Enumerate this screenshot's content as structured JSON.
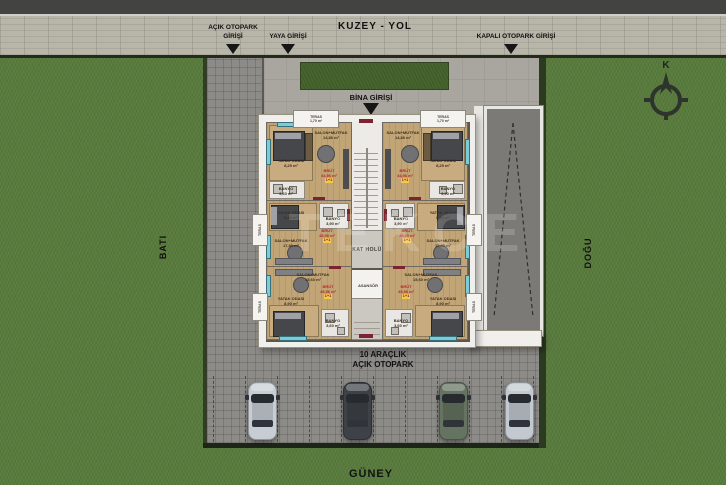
{
  "road": {
    "name_label": "KUZEY - YOL"
  },
  "entrances": {
    "open_parking_line1": "AÇIK OTOPARK",
    "open_parking_line2": "GİRİŞİ",
    "pedestrian": "YAYA GİRİŞİ",
    "closed_parking": "KAPALI OTOPARK GİRİŞİ",
    "building": "BİNA GİRİŞİ"
  },
  "compass": {
    "north_letter": "K"
  },
  "directions": {
    "west": "BATI",
    "east": "DOĞU",
    "south": "GÜNEY"
  },
  "open_parking": {
    "label_line1": "10 ARAÇLIK",
    "label_line2": "AÇIK OTOPARK",
    "capacity": 10,
    "car_colors": [
      "#c7cdd4",
      "#3e4248",
      "#657461",
      "#c3c9d0"
    ]
  },
  "watermark_text": "TEKCE",
  "core": {
    "hall_label": "KAT HOLÜ",
    "elevator_label": "ASANSÖR"
  },
  "terraces": {
    "label": "TERAS",
    "top_area": "1,70 m²",
    "side_area": "1,50 m²"
  },
  "units": [
    {
      "id": "top-left",
      "living": "SALON+MUTFAK",
      "living_area": "14,86 m²",
      "bedroom": "YATAK ODASI",
      "bedroom_area": "8,25 m²",
      "bath": "BANYO",
      "bath_area": "3,60 m²",
      "gross_label": "BRÜT",
      "gross_area": "44,96 m²",
      "type": "1+1"
    },
    {
      "id": "top-right",
      "living": "SALON+MUTFAK",
      "living_area": "14,86 m²",
      "bedroom": "YATAK ODASI",
      "bedroom_area": "8,25 m²",
      "bath": "BANYO",
      "bath_area": "3,90 m²",
      "gross_label": "BRÜT",
      "gross_area": "44,96 m²",
      "type": "1+1"
    },
    {
      "id": "middle-left",
      "living": "SALON+MUTFAK",
      "living_area": "17,80 m²",
      "bedroom": "YATAK ODASI",
      "bedroom_area": "9,40 m²",
      "bath": "BANYO",
      "bath_area": "3,90 m²",
      "gross_label": "BRÜT",
      "gross_area": "45,90 m²",
      "type": "1+1"
    },
    {
      "id": "middle-right",
      "living": "SALON+MUTFAK",
      "living_area": "17,80 m²",
      "bedroom": "YATAK ODASI",
      "bedroom_area": "9,40 m²",
      "bath": "BANYO",
      "bath_area": "3,90 m²",
      "gross_label": "BRÜT",
      "gross_area": "45,90 m²",
      "type": "1+1"
    },
    {
      "id": "bottom-left",
      "living": "SALON+MUTFAK",
      "living_area": "15,60 m²",
      "bedroom": "YATAK ODASI",
      "bedroom_area": "8,90 m²",
      "bath": "BANYO",
      "bath_area": "3,60 m²",
      "gross_label": "BRÜT",
      "gross_area": "45,96 m²",
      "type": "1+1"
    },
    {
      "id": "bottom-right",
      "living": "SALON+MUTFAK",
      "living_area": "15,60 m²",
      "bedroom": "YATAK ODASI",
      "bedroom_area": "8,90 m²",
      "bath": "BANYO",
      "bath_area": "3,60 m²",
      "gross_label": "BRÜT",
      "gross_area": "45,96 m²",
      "type": "1+1"
    }
  ],
  "colors": {
    "wall_red": "#7e2230",
    "window_teal": "#7bccd4",
    "grass_green": "#587a3c",
    "plaza_gray": "#a9a69f",
    "paver_gray": "#8d8b87",
    "road_asphalt": "#434341"
  }
}
